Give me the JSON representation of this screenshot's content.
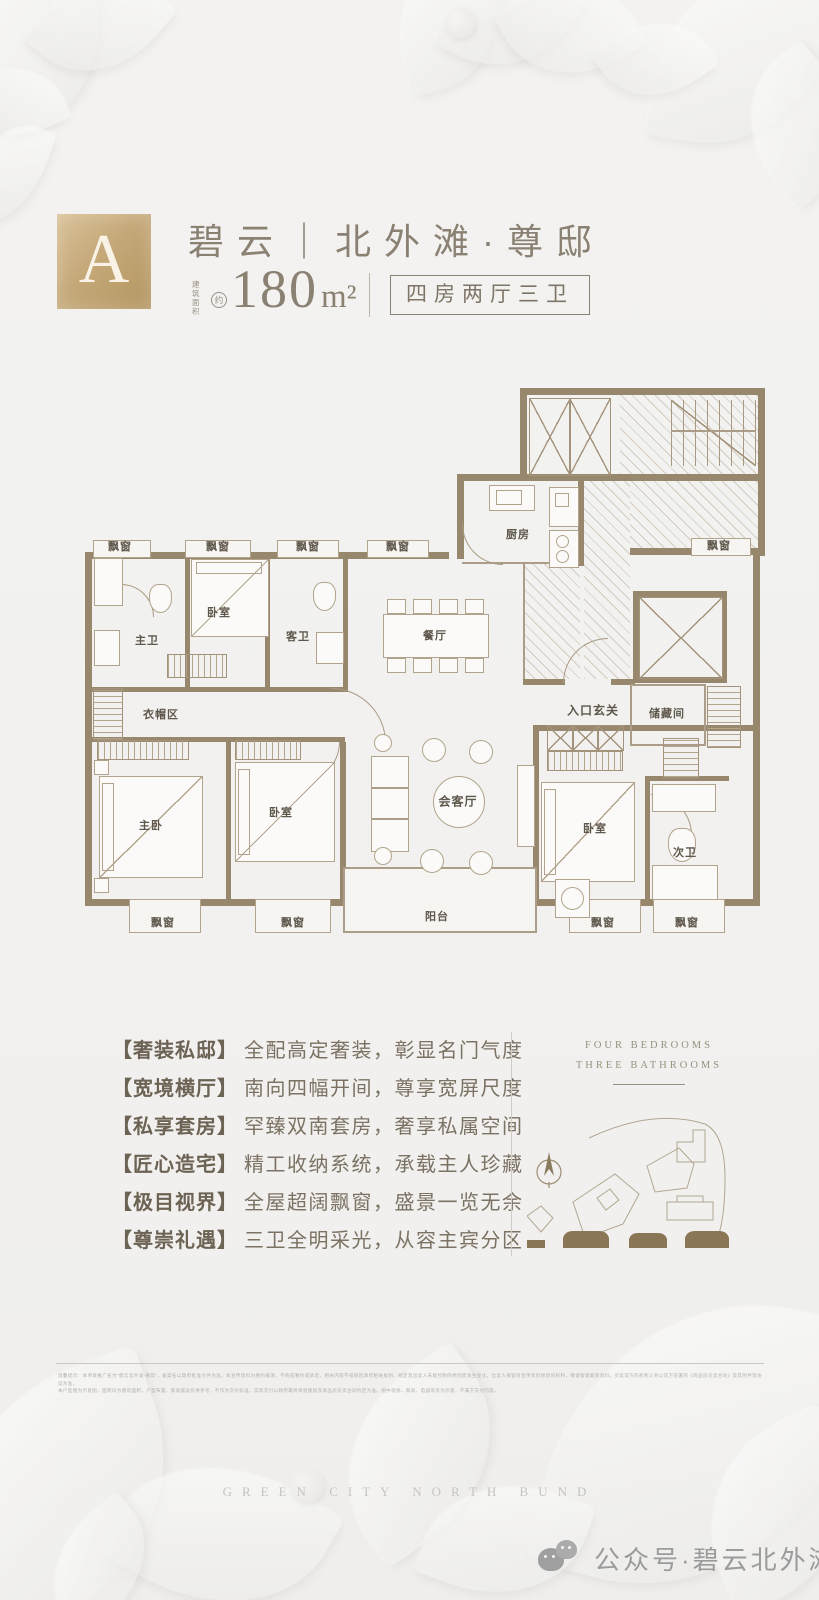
{
  "header": {
    "block_letter": "A",
    "title": "碧云｜北外滩·尊邸",
    "area_prefix": "建筑面积",
    "area_approx": "约",
    "area_value": "180",
    "area_unit": "m²",
    "layout_box": "四房两厅三卫"
  },
  "floorplan": {
    "labels": [
      "飘窗",
      "飘窗",
      "飘窗",
      "飘窗",
      "飘窗",
      "主卫",
      "卧室",
      "客卫",
      "厨房",
      "餐厅",
      "衣帽区",
      "入口玄关",
      "储藏间",
      "主卧",
      "卧室",
      "会客厅",
      "卧室",
      "次卫",
      "阳台",
      "飘窗",
      "飘窗",
      "飘窗",
      "飘窗"
    ]
  },
  "features": [
    {
      "tag": "【奢装私邸】",
      "desc": "全配高定奢装，彰显名门气度"
    },
    {
      "tag": "【宽境横厅】",
      "desc": "南向四幅开间，尊享宽屏尺度"
    },
    {
      "tag": "【私享套房】",
      "desc": "罕臻双南套房，奢享私属空间"
    },
    {
      "tag": "【匠心造宅】",
      "desc": "精工收纳系统，承载主人珍藏"
    },
    {
      "tag": "【极目视界】",
      "desc": "全屋超阔飘窗，盛景一览无余"
    },
    {
      "tag": "【尊崇礼遇】",
      "desc": "三卫全明采光，从容主宾分区"
    }
  ],
  "side_panel": {
    "line1": "FOUR BEDROOMS",
    "line2": "THREE BATHROOMS"
  },
  "footer": {
    "disclaimer_line1": "温馨提示：本项目推广名为“碧云北外滩·尊邸”，备案名以政府批准文件为准。本宣传资料为要约邀请，不构成要约或承诺，相关内容不排除因政府相关规划、规定及出卖人未能控制的原因而发生变化，出卖人保留对宣传资料修改的权利，敬请留意最新资料。买卖双方的权利义务以双方签署的《商品房买卖合同》及其附件等协议为准。",
    "disclaimer_line2": "本户型图为示意图，面积均为建筑面积，户型布置、家具摆设仅供参考，不作为交付标准，实际交付以政府最终审批图纸及商品房买卖合同约定为准。图中装修、家具、电器等仅为示意，不属于交付内容。",
    "watermark": "GREEN CITY NORTH BUND",
    "wechat_label": "公众号·碧云北外滩"
  },
  "colors": {
    "gold": "#c5a979",
    "wall_brown": "#97876d",
    "text_brown": "#8a8173",
    "site_building_fill": "#8a7657"
  }
}
